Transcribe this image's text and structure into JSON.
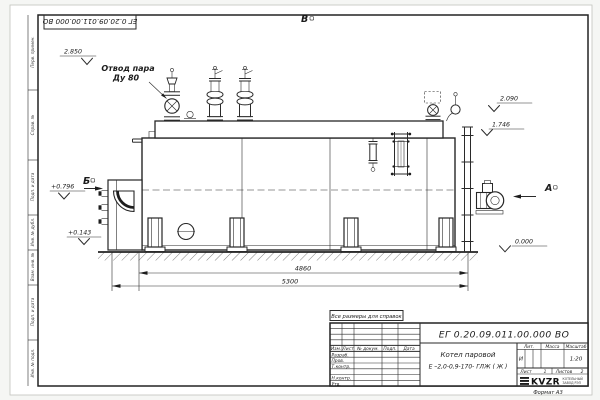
{
  "colors": {
    "ink": "#222222",
    "paper": "#ffffff",
    "background": "#f5f6f4"
  },
  "sheet": {
    "corner_designation": "ЕГ 0.20.09.011.00.000  ВО",
    "margins": {
      "m1": "Перв. примен.",
      "m2": "Справ. №",
      "m3": "Подп. и дата",
      "m4": "Инв. № дубл.",
      "m5": "Взам. инв. №",
      "m6": "Подп. и дата",
      "m7": "Инв. № подл."
    }
  },
  "drawing": {
    "view_top": "В",
    "view_left": "Б",
    "view_right": "А",
    "callout_1": "Отвод пара",
    "callout_2": "Ду 80",
    "elev_drum_top": "2.850",
    "elev_upper": "2.090",
    "elev_body_top": "1.746",
    "elev_burner": "+0.796",
    "elev_base": "+0.143",
    "elev_ground": "0.000",
    "dim_inner": "4860",
    "dim_outer": "5300"
  },
  "title_block": {
    "note": "Все размеры для справок",
    "designation": "ЕГ 0.20.09.011.00.000  ВО",
    "name_line1": "Котел паровой",
    "name_line2": "Е –2,0-0,9-170- ГЛЖ ( Ж )",
    "col_izm": "Изм.",
    "col_list": "Лист",
    "col_doc": "№ докум.",
    "col_sign": "Подп.",
    "col_date": "Дата",
    "row_developed": "Разраб.",
    "row_checked": "Пров.",
    "row_tcontrol": "Т.контр.",
    "row_ncontrol": "Н.контр.",
    "row_approved": "Утв.",
    "lit_header": "Лит.",
    "lit_value": "И",
    "mass_header": "Масса",
    "scale_header": "Масштаб",
    "scale_value": "1:20",
    "sheet_label": "Лист",
    "sheet_value": "1",
    "sheets_label": "Листов",
    "sheets_value": "2",
    "logo": "KVZR",
    "logo_line1": "КОТЕЛЬНЫЙ",
    "logo_line2": "ЗАВОД РЭП",
    "format": "Формат А3"
  }
}
